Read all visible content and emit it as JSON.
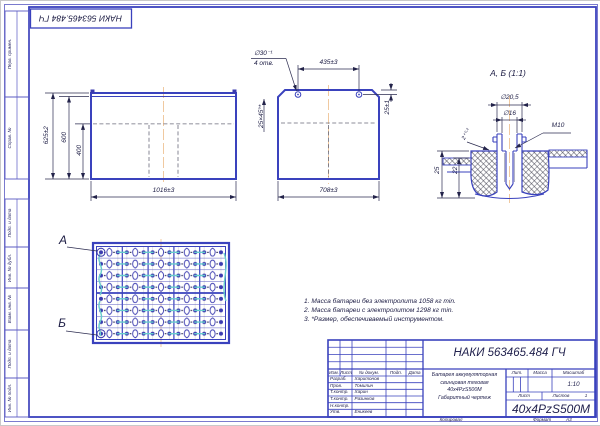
{
  "stamp": {
    "code": "НАКИ 563465.484 ГЧ"
  },
  "margin": {
    "labels": [
      "Перв. примен.",
      "Справ. №",
      "Подп. и дата",
      "Инв. № дубл.",
      "Взам. инв. №",
      "Подп. и дата",
      "Инв. № подл."
    ]
  },
  "front_view": {
    "height_total": "625±2",
    "height_lid": "600",
    "height_inner": "400",
    "width": "1016±3"
  },
  "side_view": {
    "hole_dia": "∅30⁻¹",
    "hole_count": "4 отв.",
    "pitch": "435±3",
    "offset": "25±1",
    "chamfer": "25×45°*",
    "width": "708±3"
  },
  "plan_view": {
    "marker_a": "А",
    "marker_b": "Б"
  },
  "detail_view": {
    "title": "А, Б (1:1)",
    "dia_outer": "∅20,5",
    "dia_inner": "∅16",
    "thread": "М10",
    "lip": "2⁺⁰·²",
    "height_total": "25",
    "height_inner": "22"
  },
  "notes": {
    "line1": "1. Масса батареи без электролита 1058 кг min.",
    "line2": "2. Масса батареи с электролитом 1298 кг min.",
    "line3": "3. *Размер, обеспечиваемый инструментом."
  },
  "title_block": {
    "designation": "НАКИ 563465.484 ГЧ",
    "rev_headers": {
      "izm": "Изм.",
      "list": "Лист",
      "doc": "№ докум.",
      "sign": "Подп.",
      "date": "Дата"
    },
    "staff": [
      {
        "role": "Разраб.",
        "name": "Харитонов"
      },
      {
        "role": "Пров.",
        "name": "Томилин"
      },
      {
        "role": "Т.контр.",
        "name": "Харин"
      },
      {
        "role": "Т.контр.",
        "name": "Разинков"
      },
      {
        "role": "Н.контр.",
        "name": ""
      },
      {
        "role": "Утв.",
        "name": "Еникеев"
      }
    ],
    "description": {
      "line1": "Батарея аккумуляторная",
      "line2": "свинцовая тяговая",
      "line3": "40x4PzS500M",
      "line4": "Габаритный чертеж"
    },
    "lit_label": "Лит.",
    "mass_label": "Масса",
    "scale_label": "Масштаб",
    "scale_value": "1:10",
    "sheet_label": "Лист",
    "sheets_label": "Листов",
    "sheets_value": "1",
    "model": "40x4PzS500M",
    "copied": "Копировал",
    "format": "Формат",
    "format_value": "А3"
  },
  "colors": {
    "line_blue": "#3a42bd",
    "centerline": "#f0c9a0",
    "connector": "#66cccc",
    "hatch": "#2a2a3a"
  }
}
